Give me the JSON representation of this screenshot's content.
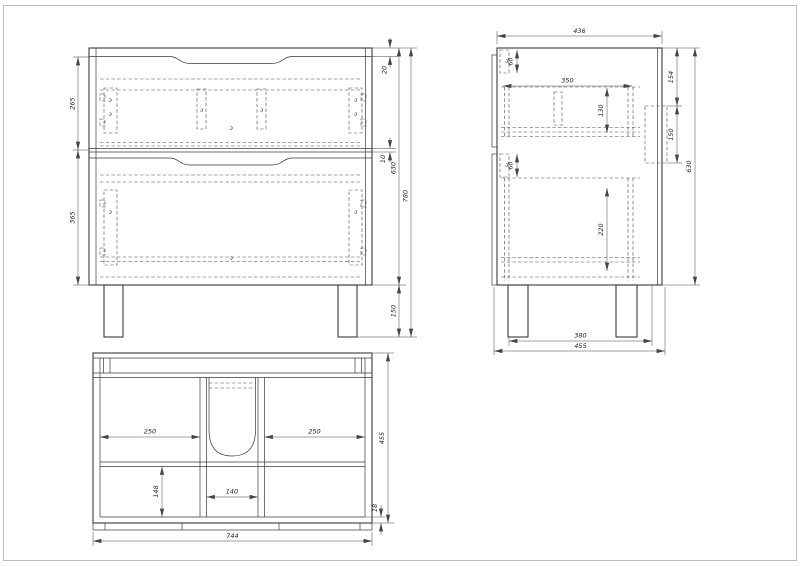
{
  "sheet": {
    "background": "#ffffff",
    "frame_color": "#b5b5b5",
    "line_color": "#3a3a3a",
    "hidden_line_color": "#4a4a4a",
    "dimension_color": "#454545"
  },
  "views": {
    "front": {
      "title": "front view of two-drawer vanity cabinet",
      "dims": {
        "top_drawer_front_height": "265",
        "bottom_drawer_front_height": "365",
        "top_panel_thickness": "20",
        "drawer_gap": "10",
        "carcass_height": "630",
        "total_height": "780",
        "leg_height": "150"
      }
    },
    "side": {
      "title": "side section view",
      "dims": {
        "top_depth": "436",
        "top_rail_height": "60",
        "drawer_depth": "350",
        "top_drawer_box_height": "130",
        "mid_rail_height": "60",
        "bottom_drawer_box_height": "220",
        "back_cutout_top_offset": "154",
        "back_cutout_height": "150",
        "carcass_height": "630",
        "leg_spacing": "380",
        "base_depth": "455"
      }
    },
    "plan": {
      "title": "plan (top) view with plumbing cutout",
      "dims": {
        "left_bay_width": "250",
        "right_bay_width": "250",
        "center_bay_width": "140",
        "front_bay_depth": "148",
        "total_depth": "455",
        "front_panel_thickness": "18",
        "total_width": "744"
      }
    }
  }
}
